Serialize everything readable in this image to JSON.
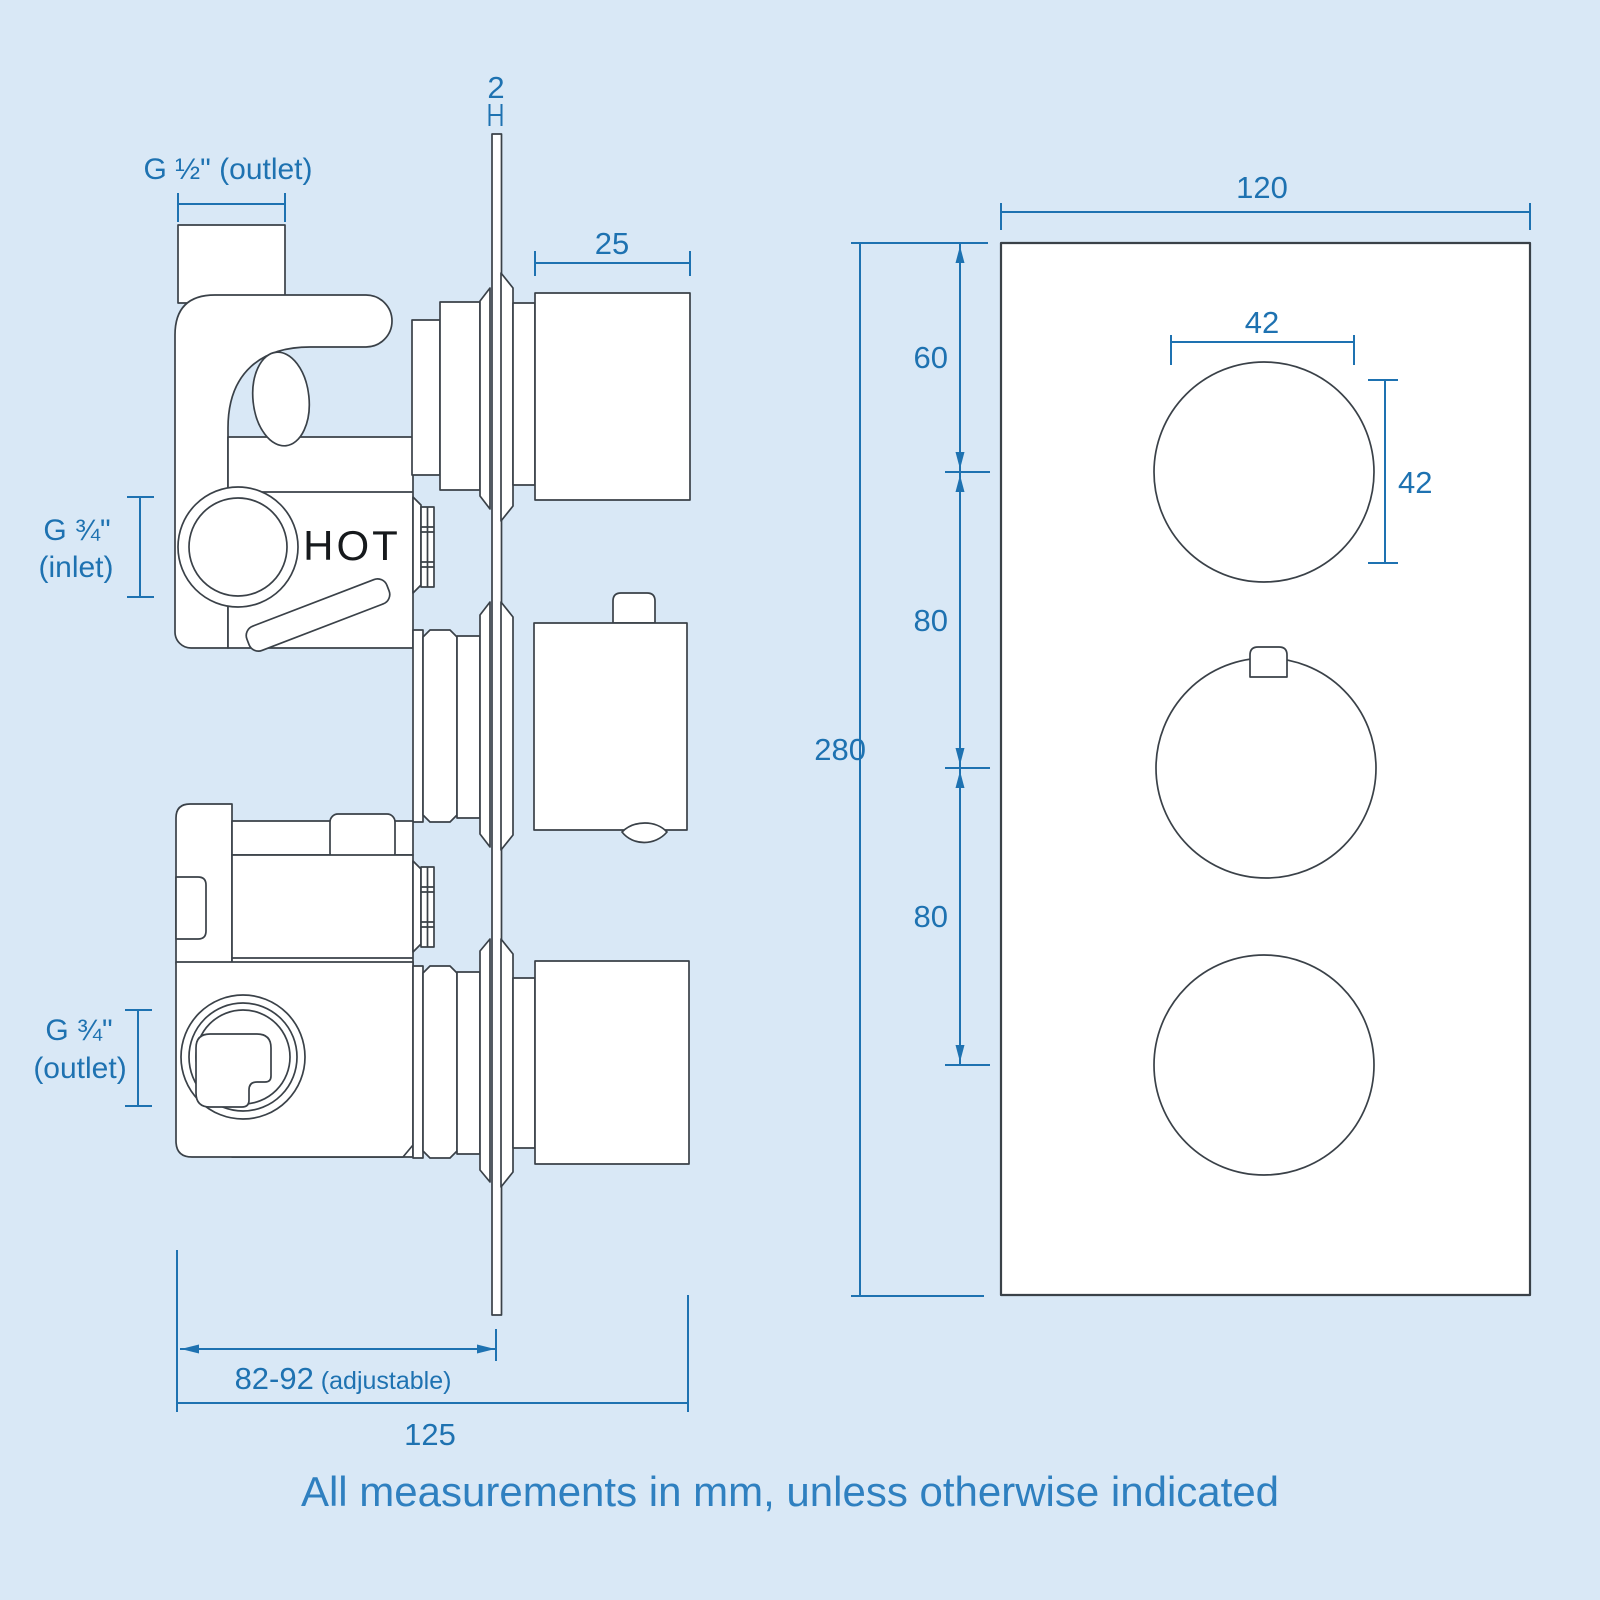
{
  "footer_note": "All measurements in mm, unless otherwise indicated",
  "side_view": {
    "label_outlet_top": "G ½\" (outlet)",
    "label_inlet_line1": "G ¾\"",
    "label_inlet_line2": "(inlet)",
    "label_outlet_bottom_line1": "G ¾\"",
    "label_outlet_bottom_line2": "(outlet)",
    "hot_label": "HOT",
    "dim_plate_thickness": "2",
    "dim_knob_depth": "25",
    "dim_adjustable_value": "82-92",
    "dim_adjustable_suffix": " (adjustable)",
    "dim_total_depth": "125"
  },
  "front_view": {
    "dim_plate_width": "120",
    "dim_top_offset": "60",
    "dim_knob_spacing_1": "80",
    "dim_knob_spacing_2": "80",
    "dim_plate_height": "280",
    "dim_knob_diameter_w": "42",
    "dim_knob_diameter_h": "42"
  },
  "colors": {
    "background": "#d9e8f6",
    "surface": "#ffffff",
    "dim_blue": "#1e72b1",
    "footer_blue": "#2f80c0",
    "line_dark": "#3a4148",
    "text_dark": "#16191c"
  }
}
